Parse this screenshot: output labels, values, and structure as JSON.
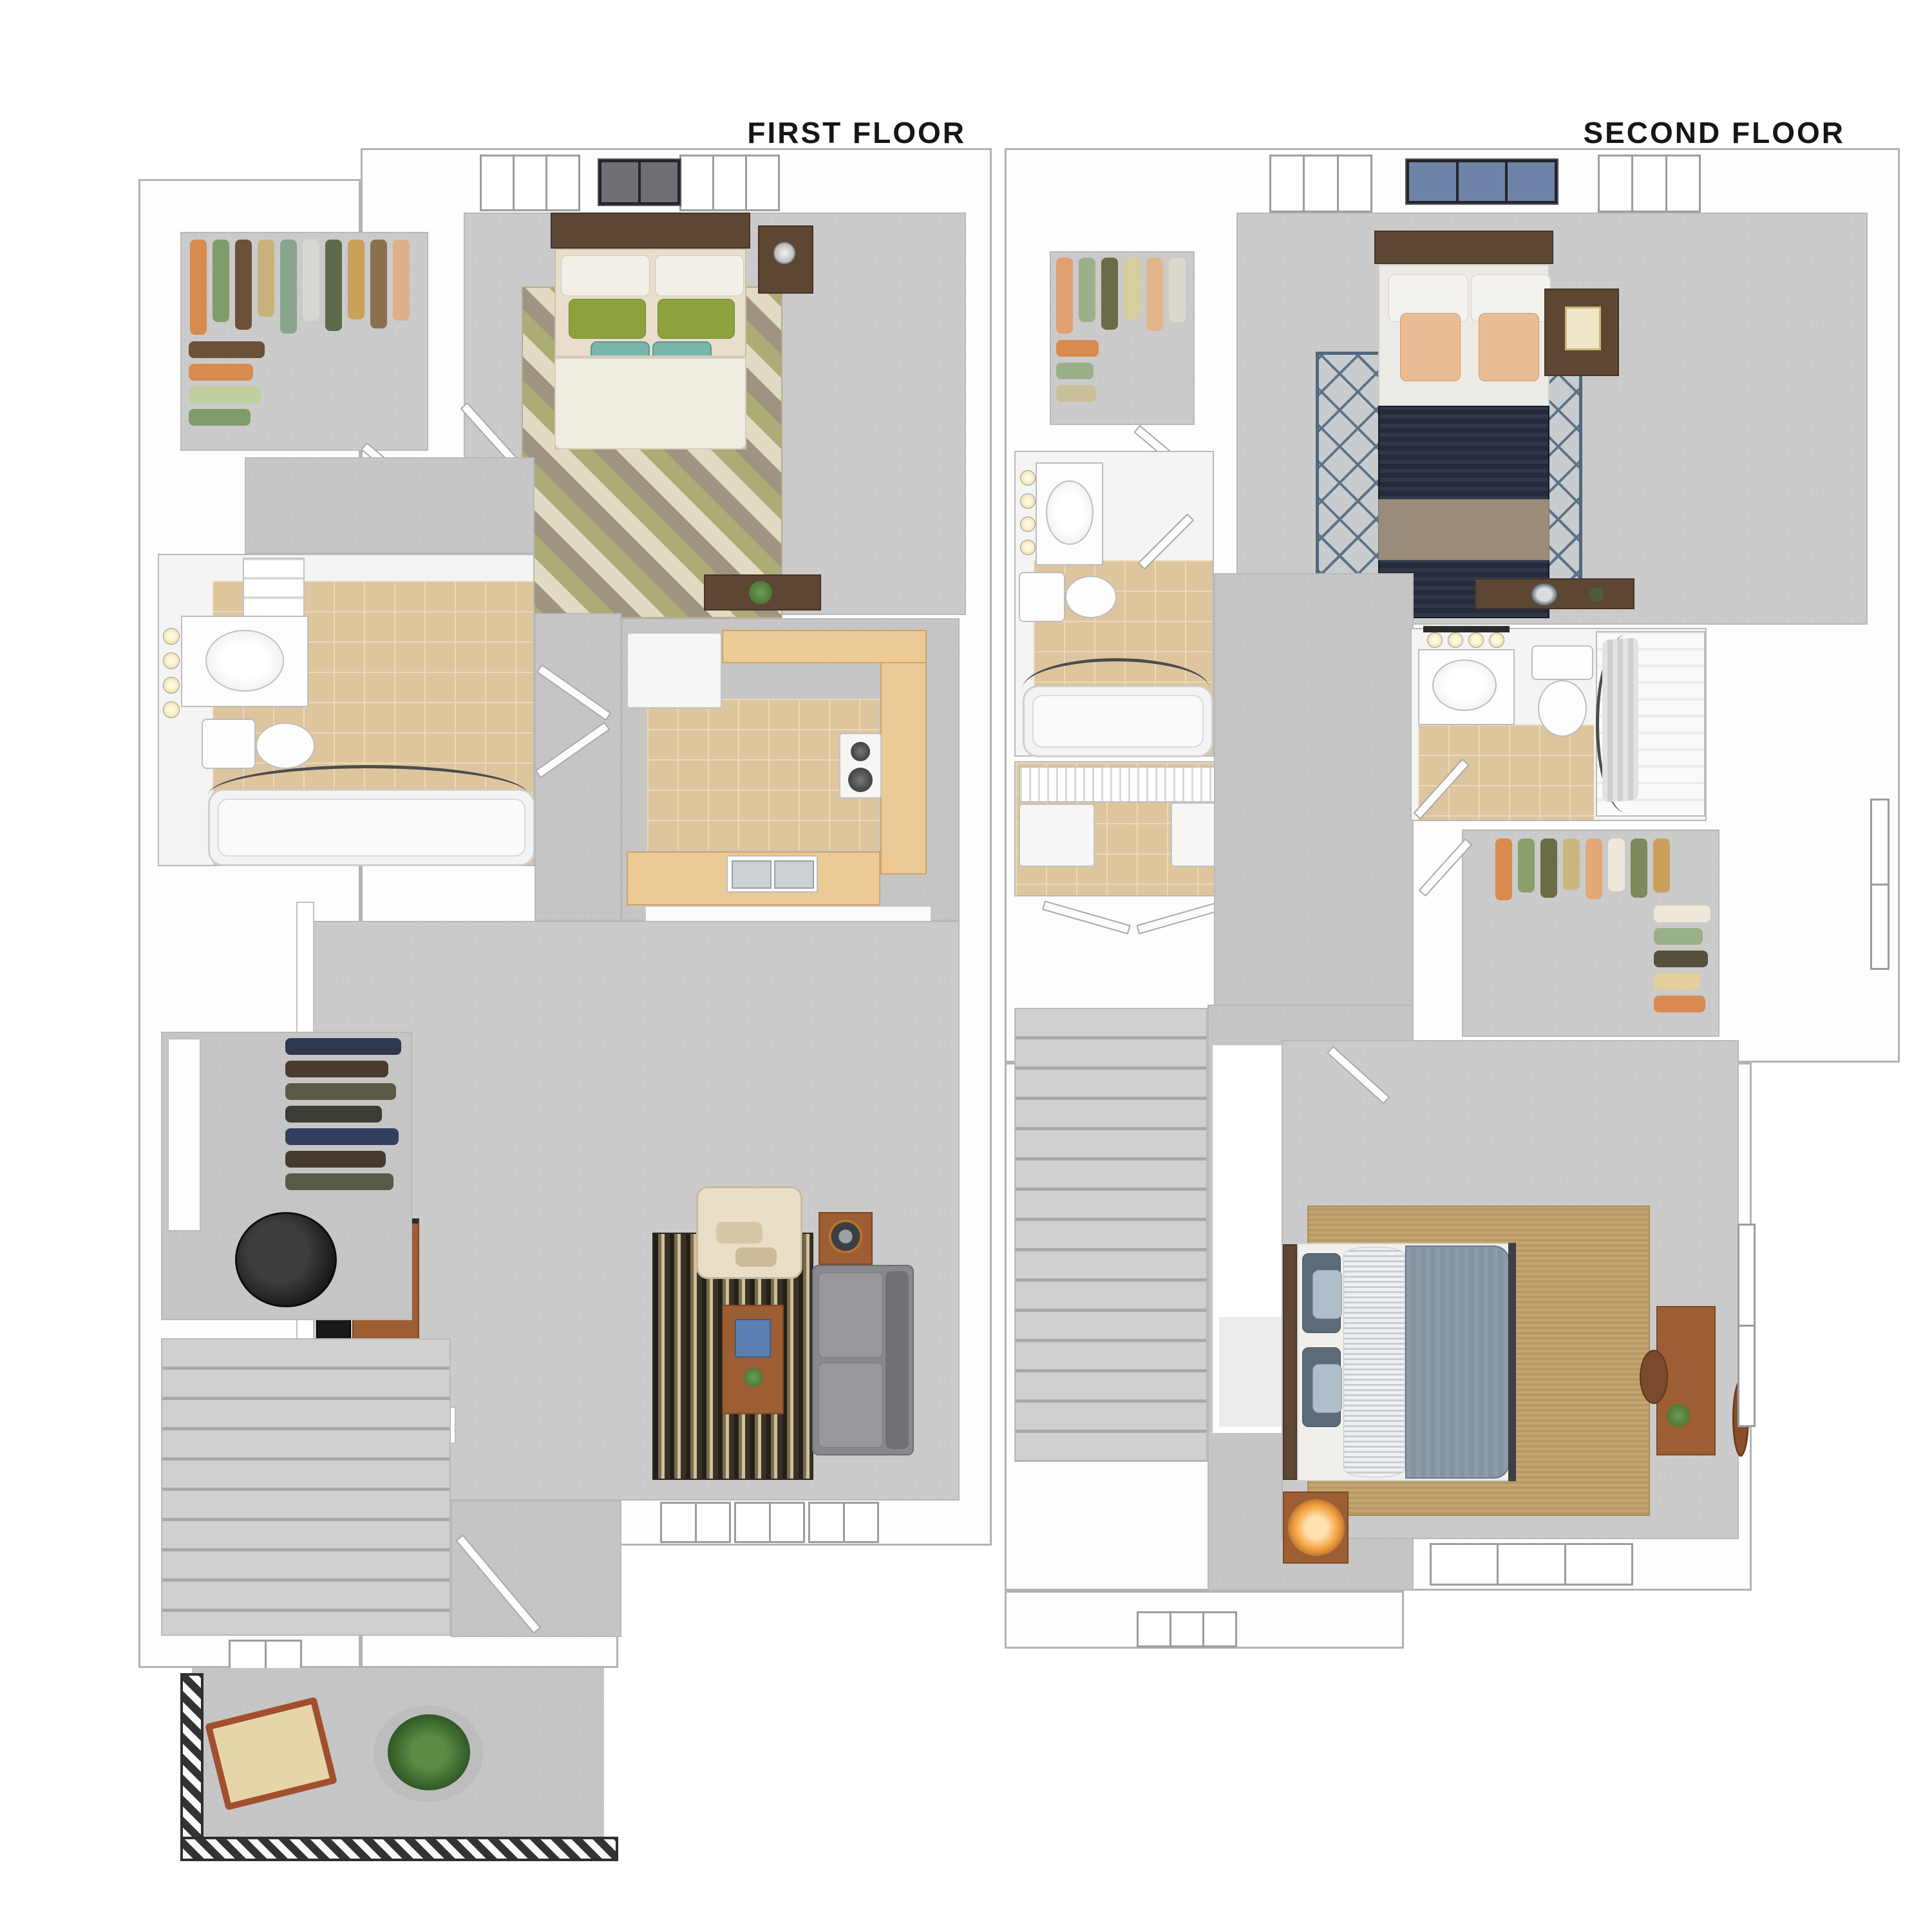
{
  "page": {
    "type": "3d-floor-plan-rendering",
    "background": "#ffffff"
  },
  "floors": [
    {
      "id": "first-floor",
      "label": "FIRST FLOOR",
      "rooms": [
        "walk-in-closet",
        "bedroom",
        "bathroom",
        "hallway",
        "kitchen",
        "living-room",
        "utility-closet",
        "staircase",
        "entry",
        "balcony"
      ],
      "furniture": [
        "queen-bed",
        "nightstand-with-lamp",
        "geometric-rug",
        "wall-art",
        "dresser-desk",
        "linen-shelves",
        "vanity-sink",
        "mirror-lights",
        "toilet",
        "bathtub-with-shower-rod",
        "refrigerator",
        "upper-cabinets",
        "range-stove",
        "counter",
        "double-sink",
        "breakfast-bar",
        "bar-stools",
        "tv",
        "tv-console",
        "armchair",
        "striped-rug",
        "coffee-table",
        "sofa",
        "speaker-side-table",
        "hanging-clothes",
        "water-heater",
        "front-door",
        "lounge-chair",
        "potted-plant",
        "balcony-railing"
      ]
    },
    {
      "id": "second-floor",
      "label": "SECOND FLOOR",
      "rooms": [
        "walk-in-closet",
        "master-bedroom",
        "bathroom",
        "laundry-closet",
        "hallway",
        "second-bathroom",
        "second-walk-in-closet",
        "stairwell",
        "second-bedroom"
      ],
      "furniture": [
        "queen-bed-navy",
        "nightstand-with-frame",
        "lattice-rug",
        "wall-art",
        "dresser-with-bowl",
        "vanity-sink",
        "mirror-lights",
        "toilet",
        "bathtub-with-shower-rod",
        "washer",
        "dryer",
        "wire-shelf",
        "bifold-doors",
        "shower-with-curtain",
        "hanging-clothes",
        "stair-opening",
        "bed-gray-blue",
        "jute-rug",
        "nightstand-with-lit-lamp",
        "desk-with-chair",
        "wall-mirror",
        "windows"
      ]
    }
  ],
  "palette": {
    "wall": "#ffffff",
    "wall_line": "#b3b3b3",
    "carpet_gray": "#cbcbcb",
    "tile_tan": "#ddc59e",
    "counter_wood": "#ecca96",
    "dark_wood": "#5d4733",
    "medium_wood": "#9e5e33",
    "bed_linen_cream": "#f1ece1",
    "green_pillow": "#8da23f",
    "teal_pillow": "#79b7ab",
    "peach_pillow": "#e8bd95",
    "navy_duvet": "#252b3d",
    "slate_duvet": "#8494a1",
    "light_blue_pillow": "#aebfca",
    "sofa_gray": "#87898c",
    "armchair_cream": "#e9dfc8",
    "rug_stripe_dark": "#241f19",
    "rug_stripe_cream": "#cfc19a",
    "lattice_line": "#5d7287",
    "jute": "#c5a66f",
    "railing_dark": "#2e2e2e",
    "water_heater_black": "#141414",
    "lamp_glow_orange": "#f2a13c",
    "label_text": "#161616"
  }
}
